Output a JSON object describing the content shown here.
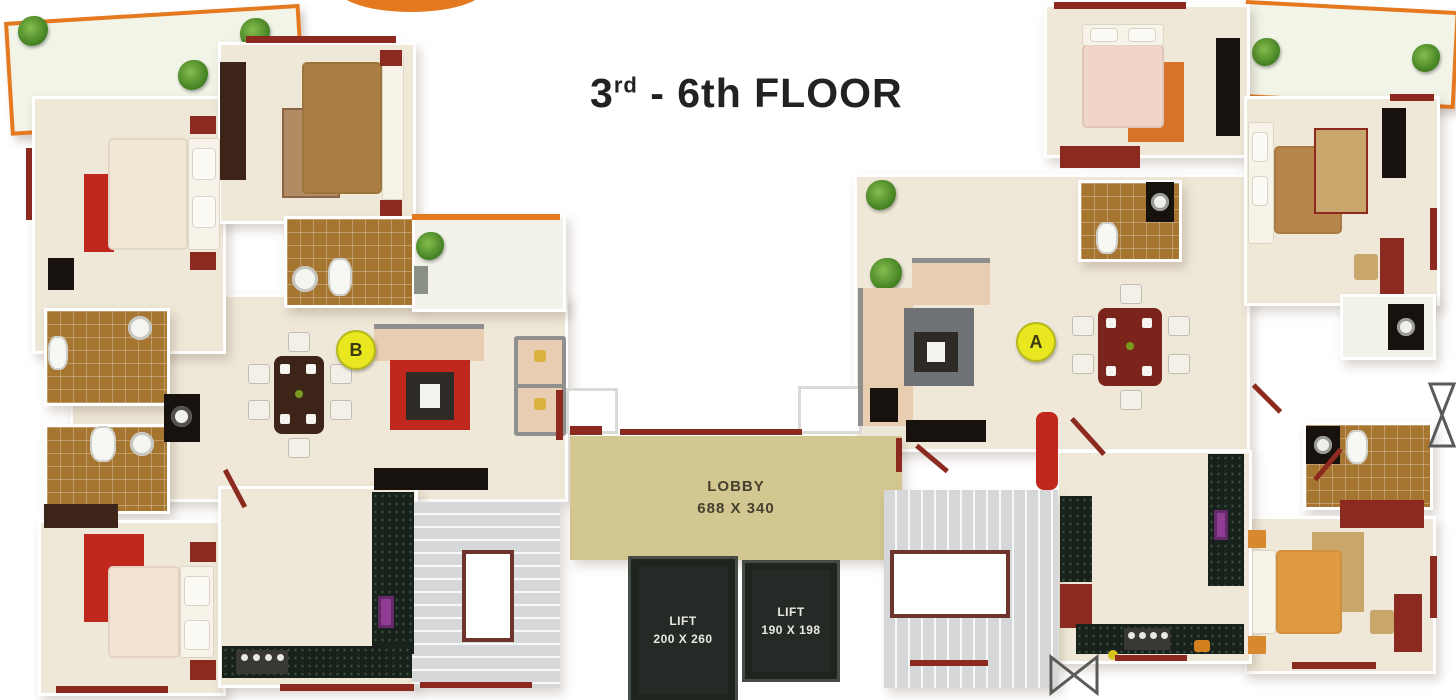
{
  "title": {
    "prefix": "3",
    "sup": "rd",
    "rest": " - 6th FLOOR"
  },
  "lobby": {
    "label": "LOBBY",
    "dims": "688 X 340"
  },
  "lifts": [
    {
      "label": "LIFT",
      "dims": "200 X 260"
    },
    {
      "label": "LIFT",
      "dims": "190 X 198"
    }
  ],
  "markers": {
    "a": "A",
    "b": "B"
  },
  "colors": {
    "wall": "#8c2a20",
    "floor": "#efe8d8",
    "lobbyBg": "#d2c691",
    "lobbyText": "#46412f",
    "liftBg": "#262a26",
    "liftText": "#e9e9e3",
    "stairBg": "#d5d7d9",
    "graniteBg": "#18211b",
    "tileBg": "#a6752f",
    "orange": "#e5791f",
    "markerBg": "#e9e71f",
    "markerText": "#3a3a10",
    "red": "#c0281d",
    "sofa": "#e8cdb0",
    "titleColor": "#222222"
  }
}
